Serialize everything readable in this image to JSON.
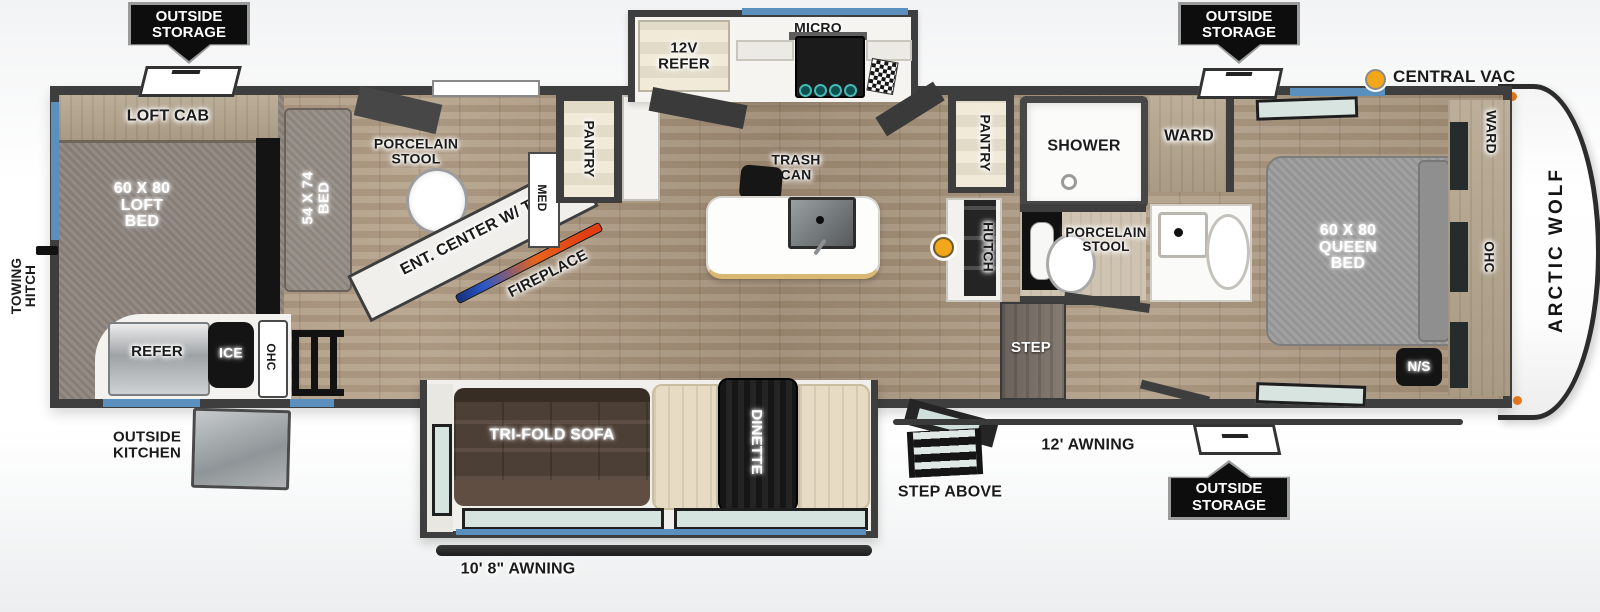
{
  "legend": {
    "central_vac_label": "CENTRAL VAC"
  },
  "exterior": {
    "outside_storage_label": "OUTSIDE\nSTORAGE",
    "outside_kitchen_label": "OUTSIDE\nKITCHEN",
    "towing_hitch_label": "TOWING\nHITCH",
    "awning_rear_label": "10' 8\" AWNING",
    "awning_main_label": "12' AWNING",
    "step_above_label": "STEP ABOVE",
    "brand_label": "ARCTIC WOLF"
  },
  "loft": {
    "loft_cab_label": "LOFT CAB",
    "loft_bed_label": "60 X 80\nLOFT\nBED",
    "bed_54_label": "54 X 74\nBED",
    "refer_label": "REFER",
    "ice_label": "ICE",
    "ohc_label": "OHC"
  },
  "rear_bath": {
    "porcelain_stool_label": "PORCELAIN\nSTOOL",
    "med_label": "MED",
    "pantry_label": "PANTRY"
  },
  "living": {
    "ent_center_label": "ENT. CENTER W/ TV",
    "fireplace_label": "FIREPLACE",
    "sofa_label": "TRI-FOLD SOFA",
    "dinette_label": "DINETTE"
  },
  "kitchen": {
    "refer_12v_label": "12V\nREFER",
    "micro_label": "MICRO",
    "trash_can_label": "TRASH\nCAN"
  },
  "mid_bath": {
    "pantry_label": "PANTRY",
    "hutch_label": "HUTCH",
    "shower_label": "SHOWER",
    "ward_label": "WARD",
    "porcelain_stool_label": "PORCELAIN\nSTOOL",
    "step_label": "STEP"
  },
  "bedroom": {
    "queen_bed_label": "60 X 80\nQUEEN\nBED",
    "ward_front_label": "WARD",
    "ohc_label": "OHC",
    "nightstand_label": "N/S"
  },
  "colors": {
    "accent_orange": "#F2A71B",
    "window_blue": "#5B8FBE",
    "wall_dark": "#3E3E3E",
    "badge_black": "#0D0D0D"
  }
}
